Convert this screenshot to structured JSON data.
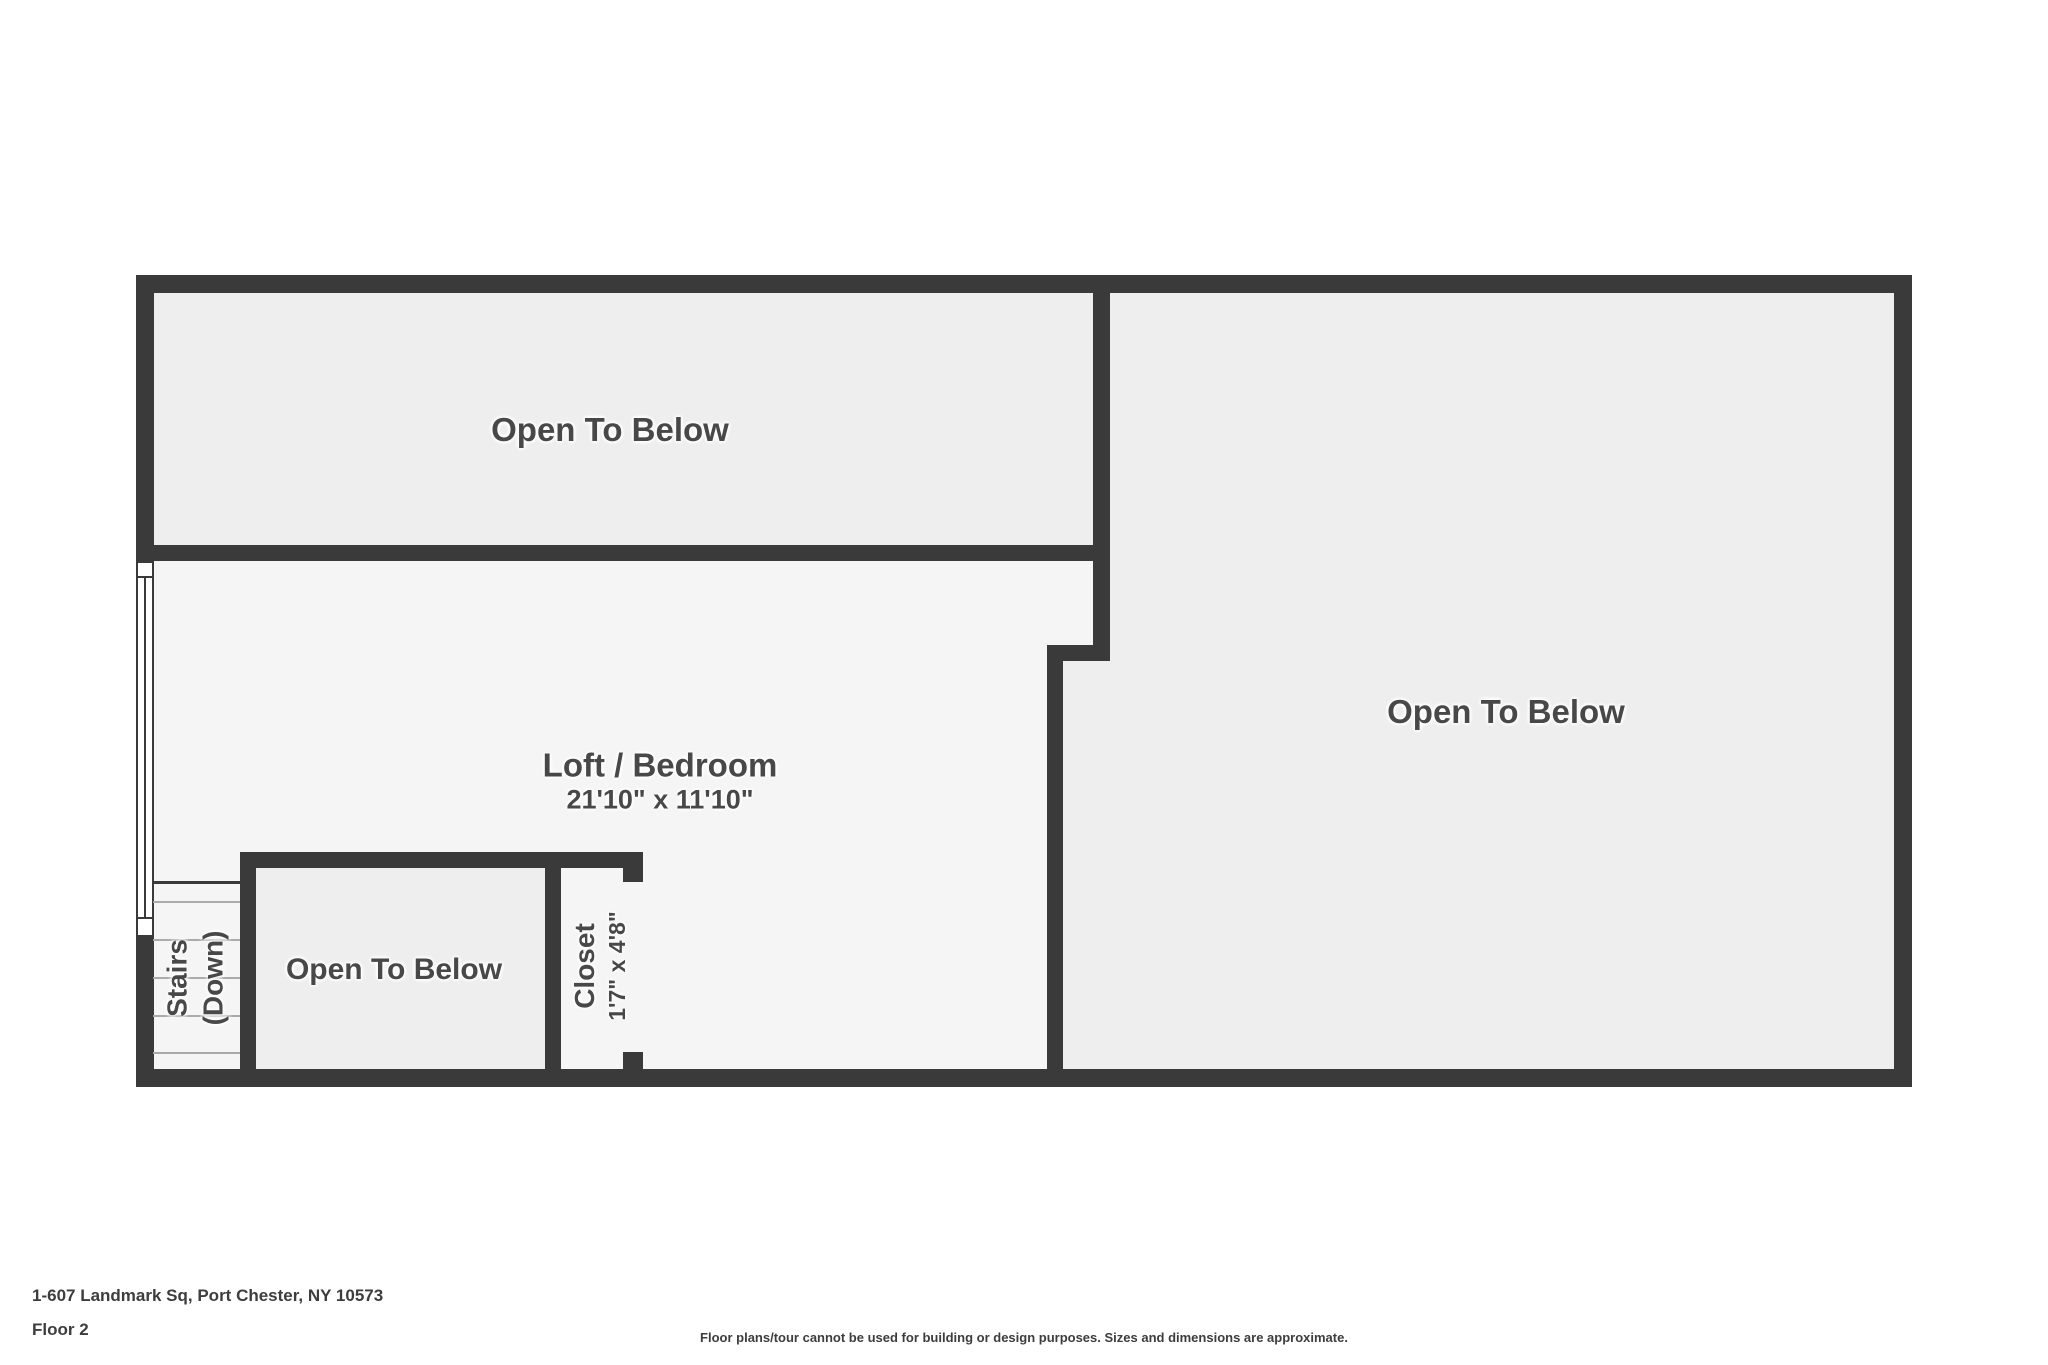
{
  "colors": {
    "wall": "#3a3a3a",
    "floor_open_to_below": "#eeeeee",
    "floor_loft": "#f5f5f5",
    "label_text": "#484848"
  },
  "rooms": {
    "open_top_left": {
      "label": "Open To Below"
    },
    "open_right": {
      "label": "Open To Below"
    },
    "open_small": {
      "label": "Open To Below"
    },
    "loft": {
      "label": "Loft / Bedroom",
      "dimensions": "21'10\" x 11'10\""
    },
    "stairs": {
      "label_line1": "Stairs",
      "label_line2": "(Down)"
    },
    "closet": {
      "label": "Closet",
      "dimensions": "1'7\" x 4'8\""
    }
  },
  "footer": {
    "address": "1-607 Landmark Sq, Port Chester, NY 10573",
    "floor": "Floor 2",
    "disclaimer": "Floor plans/tour cannot be used for building or design purposes. Sizes and dimensions are approximate."
  }
}
